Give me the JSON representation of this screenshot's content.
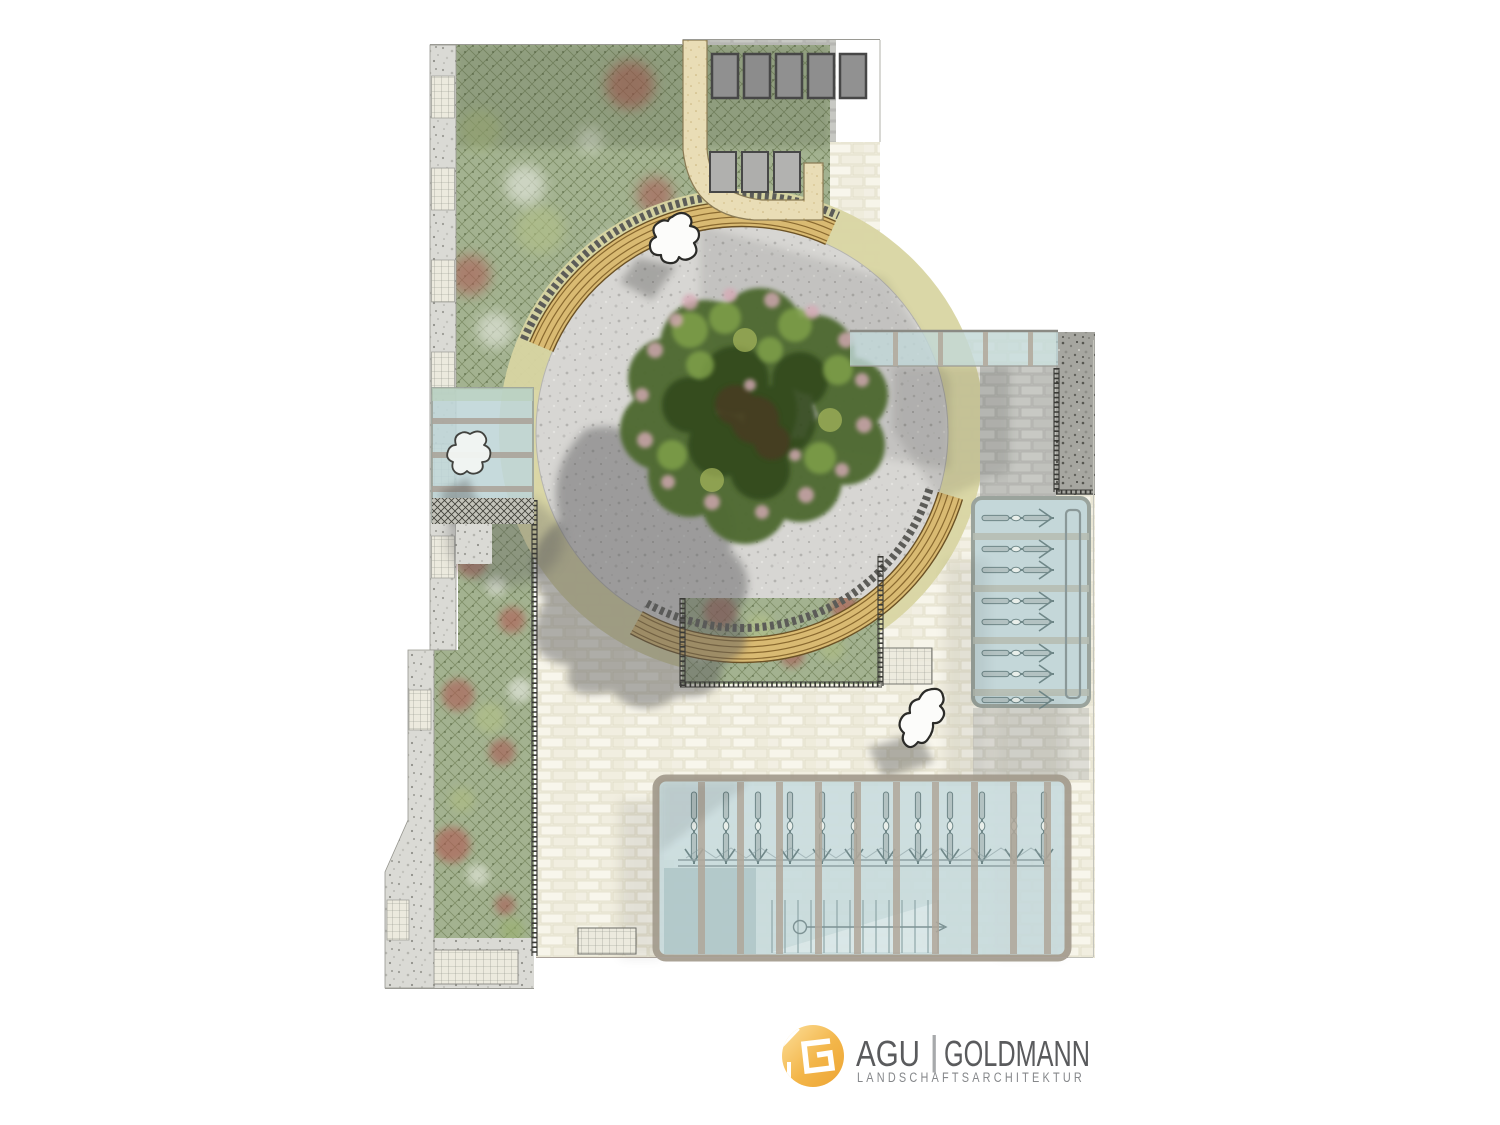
{
  "document": {
    "type_label": "landscape-architecture-site-plan",
    "background": "#ffffff"
  },
  "logo": {
    "brand": "AGU",
    "divider": "|",
    "name": "GOLDMANN",
    "subtitle": "LANDSCHAFTSARCHITEKTUR",
    "mark_gradient_top": "#fcdf9a",
    "mark_gradient_bottom": "#eda433",
    "text_color": "#5a5b5d",
    "subtitle_color": "#85878a"
  },
  "plan": {
    "features": [
      {
        "name": "circular-plaza-gravel",
        "fill": "#d7d6d3"
      },
      {
        "name": "plaza-ring-paving",
        "fill": "#d8d5a2"
      },
      {
        "name": "curved-timber-bench",
        "fill": "#d9ba72",
        "count": 2
      },
      {
        "name": "feature-tree",
        "fill": "#4f6b31",
        "count": 1
      },
      {
        "name": "planting-area-green",
        "fill": "#a3b290"
      },
      {
        "name": "brick-paving-cream",
        "fill": "#efecdc"
      },
      {
        "name": "brick-paving-grey",
        "fill": "#bbbcb7"
      },
      {
        "name": "sand-curved-wall",
        "fill": "#e9ddb6"
      },
      {
        "name": "glass-canopy",
        "fill": "#c2d8da",
        "count": 3
      },
      {
        "name": "seating-blocks-dark",
        "count": 5
      },
      {
        "name": "seating-blocks-light",
        "count": 3
      },
      {
        "name": "bicycle-stands-outdoor",
        "count": 8
      },
      {
        "name": "bicycle-stands-sheltered",
        "count": 12
      },
      {
        "name": "stairway",
        "count": 1
      },
      {
        "name": "people",
        "count": 3
      }
    ]
  }
}
